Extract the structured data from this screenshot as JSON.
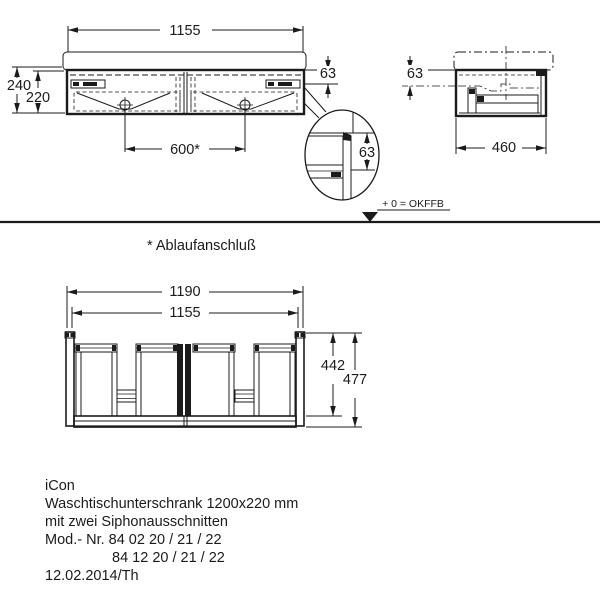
{
  "colors": {
    "line": "#1b1b1b",
    "background": "#ffffff"
  },
  "front_view": {
    "dim_width": "1155",
    "dim_height_with_basin": "240",
    "dim_height_cabinet": "220",
    "dim_basin_overhang": "63",
    "dim_drain_spacing": "600*"
  },
  "side_view": {
    "dim_basin_overhang": "63",
    "dim_depth": "460"
  },
  "detail_view": {
    "dim_offset": "63"
  },
  "level_marker": {
    "label": "+ 0 = OKFFB"
  },
  "footnote": {
    "label": "* Ablaufanschluß"
  },
  "bottom_view": {
    "dim_width_overall": "1190",
    "dim_width_body": "1155",
    "dim_depth_body": "442",
    "dim_depth_overall": "477"
  },
  "title_block": {
    "line1": "iCon",
    "line2": "Waschtischunterschrank 1200x220 mm",
    "line3": "mit zwei Siphonausschnitten",
    "line4": "Mod.- Nr. 84 02 20 / 21 / 22",
    "line5": "84 12 20 / 21 / 22",
    "line6": "12.02.2014/Th"
  }
}
